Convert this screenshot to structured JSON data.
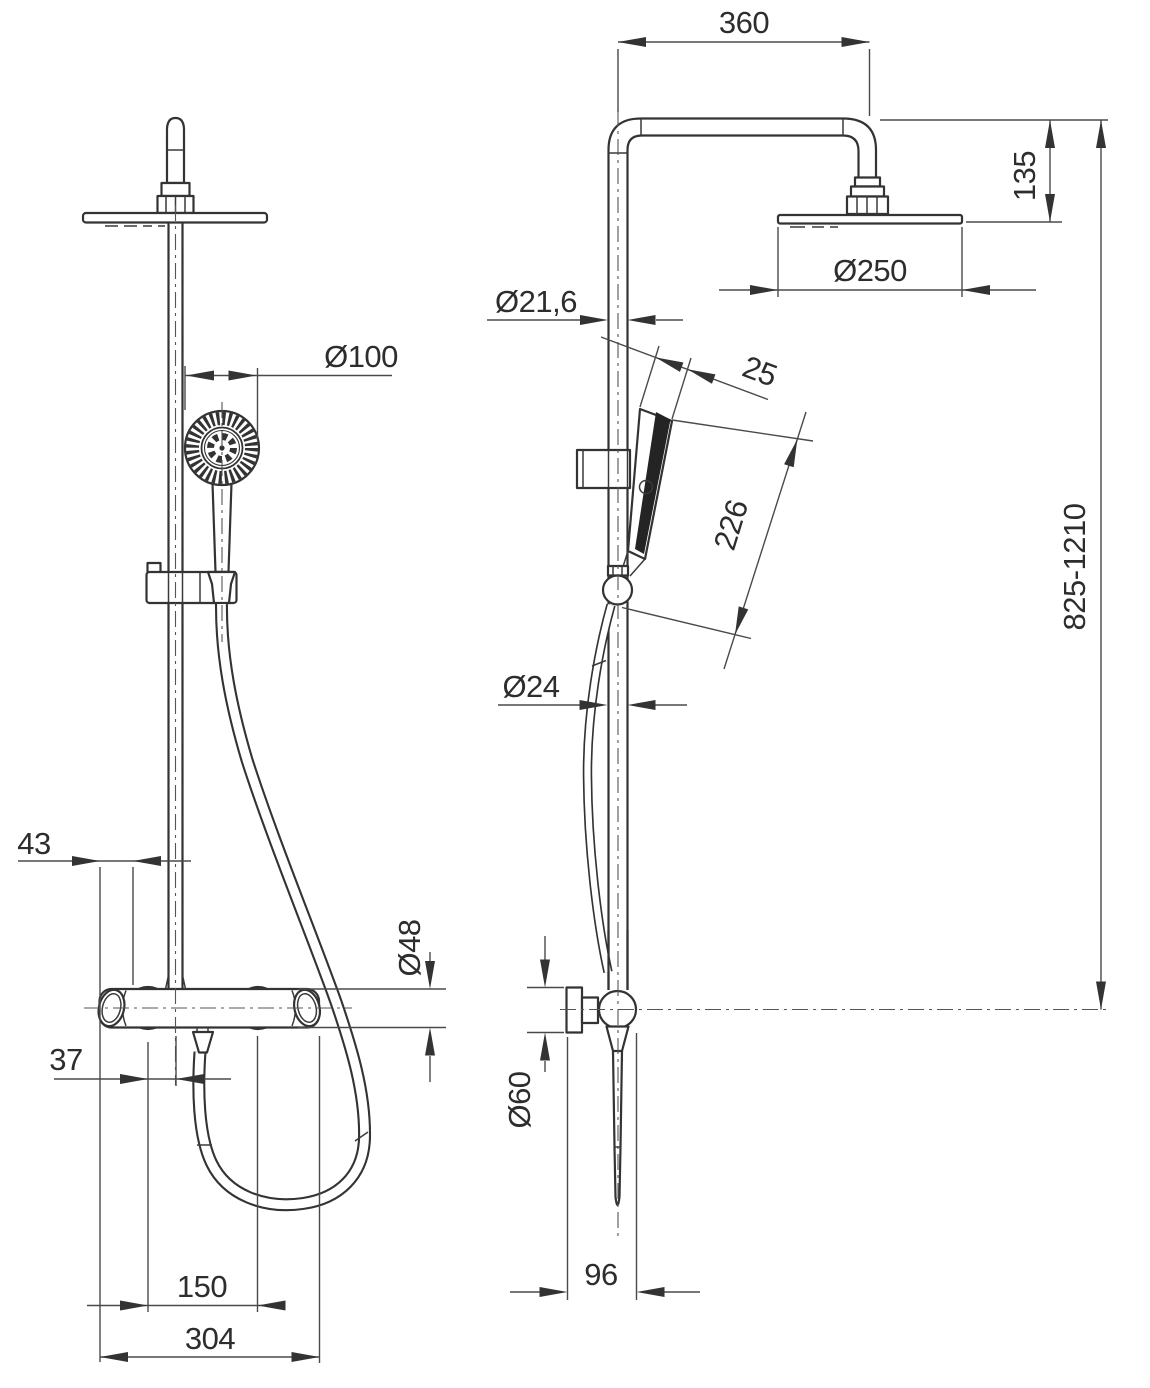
{
  "document": {
    "type": "technical dimension drawing",
    "subject": "shower column with overhead rain shower, hand shower and thermostatic bar mixer",
    "views": [
      "front view",
      "side view"
    ]
  },
  "dimensions": {
    "front": {
      "handshower_head_diameter": "Ø100",
      "mixer_end_offset": "43",
      "mixer_body_diameter": "Ø48",
      "outlet_to_center_offset": "37",
      "connection_centers_spacing": "150",
      "mixer_overall_width": "304"
    },
    "side": {
      "arm_reach": "360",
      "head_drop_height": "135",
      "head_diameter": "Ø250",
      "upper_pipe_diameter": "Ø21,6",
      "handshower_head_width": "25",
      "handshower_length": "226",
      "lower_pipe_diameter": "Ø24",
      "wall_flange_diameter": "Ø60",
      "wall_to_front_depth": "96",
      "column_height_range": "825-1210"
    }
  }
}
